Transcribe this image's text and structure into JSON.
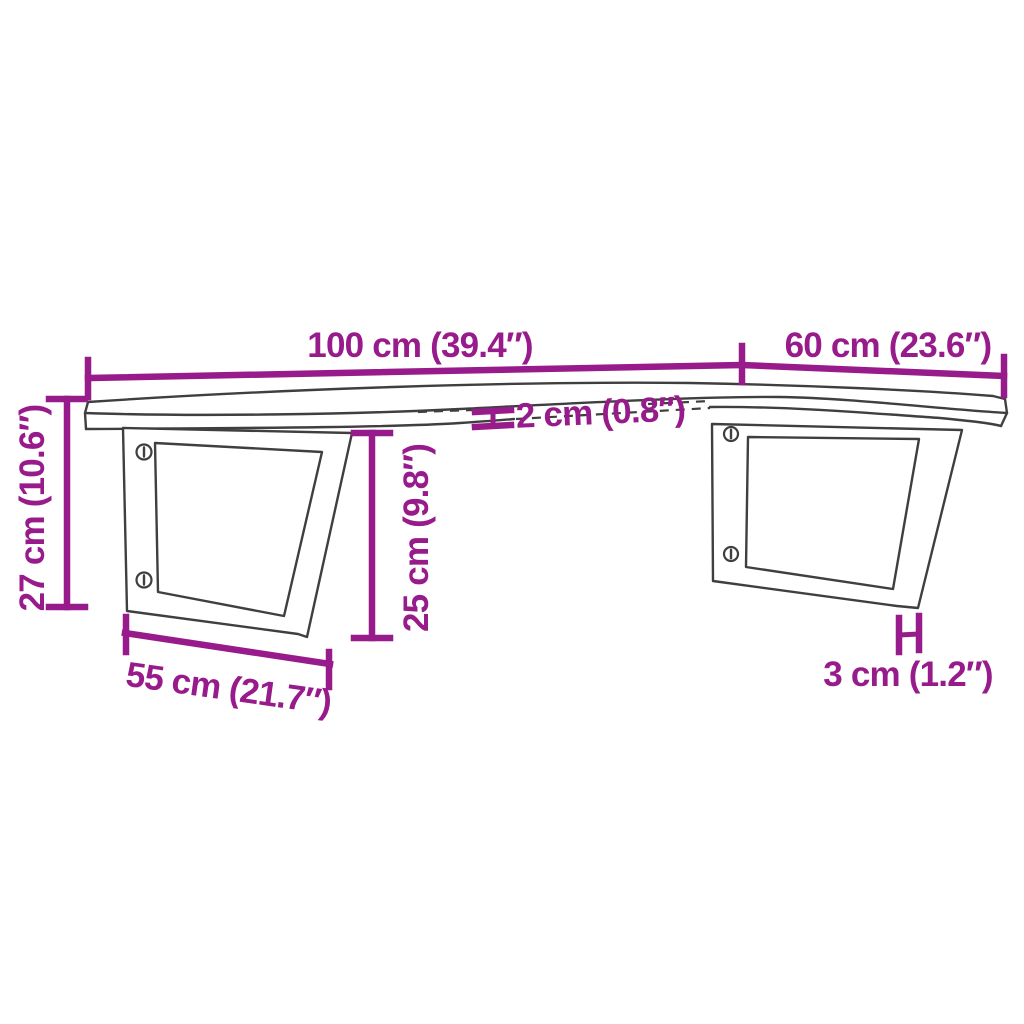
{
  "diagram": {
    "kind": "product-dimension-diagram",
    "subject": "wall-mounted live-edge shelf on two trapezoid steel brackets",
    "background_color": "#ffffff",
    "drawing_line_color": "#3f3f3f",
    "dimension_color": "#981b8b",
    "dimensions": {
      "length": {
        "label": "100 cm (39.4″)",
        "meaning": "shelf length"
      },
      "depth": {
        "label": "60 cm (23.6″)",
        "meaning": "shelf depth"
      },
      "height": {
        "label": "27 cm (10.6″)",
        "meaning": "overall height"
      },
      "top_thickness": {
        "label": "2 cm (0.8″)",
        "meaning": "shelf top thickness"
      },
      "bracket_height": {
        "label": "25 cm (9.8″)",
        "meaning": "bracket height"
      },
      "bracket_width": {
        "label": "55 cm (21.7″)",
        "meaning": "bracket bottom width"
      },
      "bracket_thickness": {
        "label": "3 cm (1.2″)",
        "meaning": "bracket steel thickness"
      }
    }
  }
}
